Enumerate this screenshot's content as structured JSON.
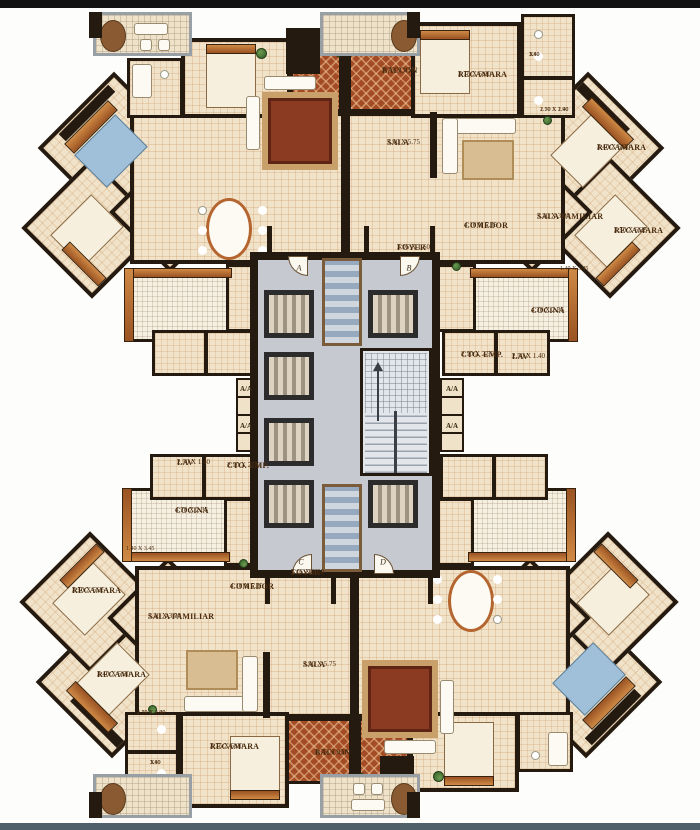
{
  "floor_plan": {
    "colors": {
      "floor_beige": "#f0e3c9",
      "wall_dark": "#241a10",
      "balcony_terracotta": "#a34b24",
      "core_gray": "#c6c9cf",
      "wood_accent": "#cf8a46",
      "bed_blue": "#9fc0d8",
      "label_brown": "#4a2c10"
    },
    "labels": {
      "top_unit": [
        {
          "name": "balcon-label",
          "lines": [
            "BALCON",
            "3.75 X 1.50"
          ],
          "x": 382,
          "y": 66
        },
        {
          "name": "recamara-label",
          "lines": [
            "RECAMARA",
            "3.75 X 5.00"
          ],
          "x": 458,
          "y": 70
        },
        {
          "name": "sala-label",
          "lines": [
            "SALA",
            "3.90 X 5.75"
          ],
          "x": 387,
          "y": 138
        },
        {
          "name": "comedor-label",
          "lines": [
            "COMEDOR",
            "4.10 X 5.35"
          ],
          "x": 464,
          "y": 221
        },
        {
          "name": "sala-familiar-label",
          "lines": [
            "SALA FAMILIAR",
            "3.20 X 3.90"
          ],
          "x": 537,
          "y": 212
        },
        {
          "name": "recamara-label",
          "lines": [
            "RECAMARA",
            "3.40 X 5.50"
          ],
          "x": 597,
          "y": 143
        },
        {
          "name": "recamara-label",
          "lines": [
            "RECAMARA",
            "3.50 X 5.35"
          ],
          "x": 614,
          "y": 226
        },
        {
          "name": "cocina-label",
          "lines": [
            "COCINA",
            "4.70 X 2.35"
          ],
          "x": 531,
          "y": 306
        },
        {
          "name": "cto-emp-label",
          "lines": [
            "CTO. EMP.",
            "2.10 X 2.55"
          ],
          "x": 461,
          "y": 350
        },
        {
          "name": "lav-label",
          "lines": [
            "LAV",
            "2.50 X 1.40"
          ],
          "x": 512,
          "y": 352
        },
        {
          "name": "foyer-label",
          "lines": [
            "FOYER",
            "3.05 X 1.60"
          ],
          "x": 397,
          "y": 243
        },
        {
          "name": "dim-label",
          "small": true,
          "lines": [
            "1.40 X 3.45"
          ],
          "x": 560,
          "y": 266
        },
        {
          "name": "dim-label",
          "small": true,
          "lines": [
            "1.80",
            "X",
            "3.40"
          ],
          "x": 529,
          "y": 52
        },
        {
          "name": "dim-label",
          "small": true,
          "lines": [
            "1.70 X 1.90",
            "2.50 X 2.40"
          ],
          "x": 540,
          "y": 107
        }
      ],
      "bottom_unit": [
        {
          "name": "lav-label",
          "lines": [
            "LAV",
            "2.50 X 1.40"
          ],
          "x": 177,
          "y": 458
        },
        {
          "name": "cto-emp-label",
          "lines": [
            "CTO. EMP.",
            "2.10 X 2.55"
          ],
          "x": 227,
          "y": 461
        },
        {
          "name": "cocina-label",
          "lines": [
            "COCINA",
            "4.70 X 2.35"
          ],
          "x": 175,
          "y": 506
        },
        {
          "name": "dim-label",
          "small": true,
          "lines": [
            "1.40 X 3.45"
          ],
          "x": 126,
          "y": 546
        },
        {
          "name": "recamara-label",
          "lines": [
            "RECAMARA",
            "3.50 X 5.35"
          ],
          "x": 72,
          "y": 586
        },
        {
          "name": "sala-familiar-label",
          "lines": [
            "SALA FAMILIAR",
            "3.20 X 3.90"
          ],
          "x": 148,
          "y": 612
        },
        {
          "name": "recamara-label",
          "lines": [
            "RECAMARA",
            "3.40 X 5.50"
          ],
          "x": 97,
          "y": 670
        },
        {
          "name": "foyer-label",
          "lines": [
            "FOYER",
            "3.05 X 1.60"
          ],
          "x": 291,
          "y": 568
        },
        {
          "name": "comedor-label",
          "lines": [
            "COMEDOR",
            "4.10 X 5.35"
          ],
          "x": 230,
          "y": 582
        },
        {
          "name": "sala-label",
          "lines": [
            "SALA",
            "3.90 X 5.75"
          ],
          "x": 303,
          "y": 660
        },
        {
          "name": "recamara-label",
          "lines": [
            "RECAMARA",
            "3.75 X 5.00"
          ],
          "x": 210,
          "y": 742
        },
        {
          "name": "balcon-label",
          "lines": [
            "BALCON",
            "3.75 X 1.50"
          ],
          "x": 315,
          "y": 748
        },
        {
          "name": "dim-label",
          "small": true,
          "lines": [
            "1.70 X 1.90",
            "2.50 X 2.40"
          ],
          "x": 137,
          "y": 710
        },
        {
          "name": "dim-label",
          "small": true,
          "lines": [
            "1.80",
            "X",
            "3.40"
          ],
          "x": 150,
          "y": 760
        }
      ],
      "core": {
        "door_letters": [
          {
            "text": "A",
            "x": 299,
            "y": 268
          },
          {
            "text": "B",
            "x": 409,
            "y": 268
          },
          {
            "text": "C",
            "x": 301,
            "y": 562
          },
          {
            "text": "D",
            "x": 383,
            "y": 562
          }
        ],
        "ac_closets": [
          {
            "text": "A/A",
            "x": 246,
            "y": 389
          },
          {
            "text": "A/A",
            "x": 452,
            "y": 389
          },
          {
            "text": "A/A",
            "x": 246,
            "y": 426
          },
          {
            "text": "A/A",
            "x": 452,
            "y": 426
          }
        ]
      }
    }
  }
}
